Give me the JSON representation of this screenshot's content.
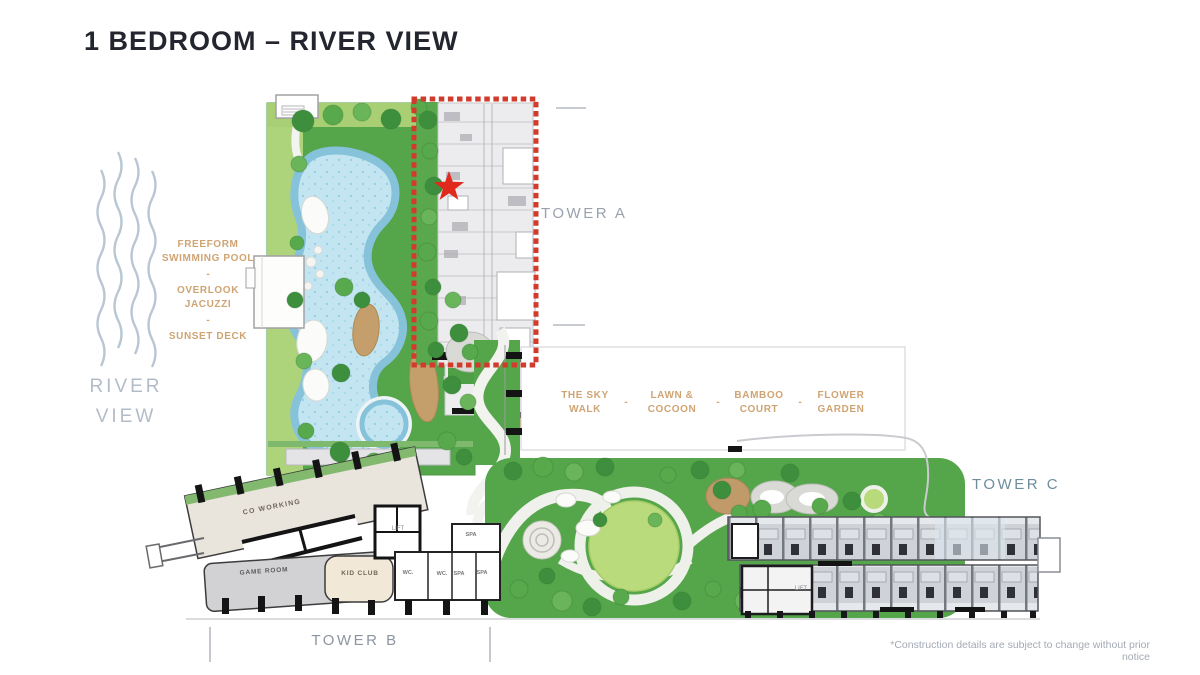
{
  "page": {
    "title": "1 BEDROOM – RIVER VIEW"
  },
  "river": {
    "label": "RIVER VIEW"
  },
  "legend_left": {
    "items": [
      "FREEFORM SWIMMING POOL",
      "OVERLOOK JACUZZI",
      "SUNSET DECK"
    ],
    "separator": "-"
  },
  "garden_amenities": {
    "items": [
      "THE SKY WALK",
      "LAWN & COCOON",
      "BAMBOO COURT",
      "FLOWER GARDEN"
    ],
    "separator": "-"
  },
  "towers": {
    "tower_a": "TOWER A",
    "tower_b": "TOWER B",
    "tower_c": "TOWER C"
  },
  "rooms": {
    "co_working": "CO WORKING",
    "game_room": "GAME ROOM",
    "kid_club": "KID CLUB",
    "lift": "LIFT",
    "wc": "WC.",
    "spa": "SPA"
  },
  "footer": {
    "disclaimer": "*Construction details are subject to change without prior notice"
  },
  "colors": {
    "accent_red": "#d23b2c",
    "label_orange": "#cfa473",
    "tower_label_gray": "#99a1ad",
    "tower_c_teal": "#6e8d9c",
    "river_blue": "#b2bcc8",
    "pool_water": "#c3e5f1",
    "landscape_green": "#55a54a",
    "lawn_light_green": "#b9db7c",
    "title_dark": "#23262f"
  }
}
